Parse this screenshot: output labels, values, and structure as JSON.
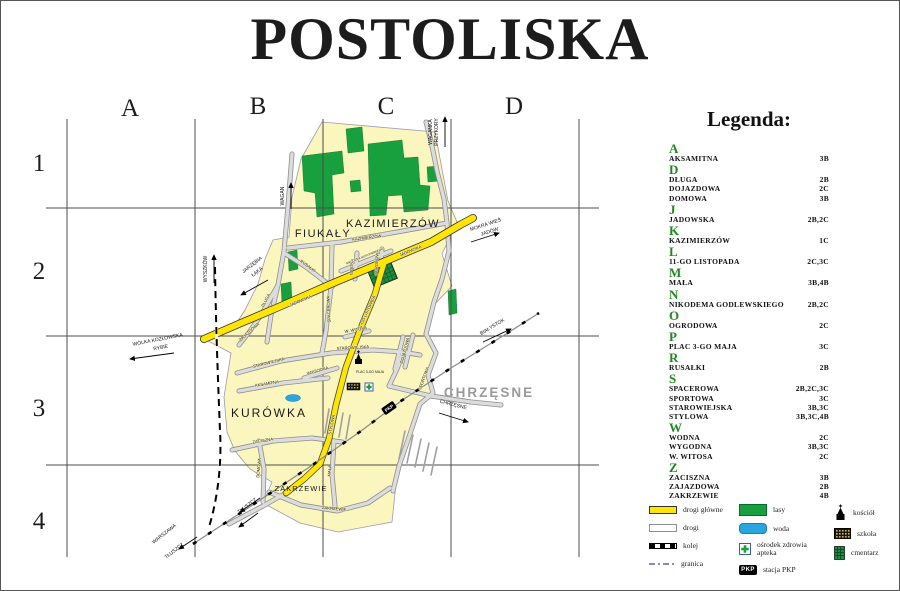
{
  "title": "POSTOLISKA",
  "grid": {
    "columns": [
      "A",
      "B",
      "C",
      "D"
    ],
    "rows": [
      "1",
      "2",
      "3",
      "4"
    ]
  },
  "colors": {
    "village": "#FBF5BE",
    "forest": "#18A03F",
    "main_road": "#FFE500",
    "water": "#2AA5DF",
    "legend_letter_green": "#1E8A1E"
  },
  "map": {
    "areas": {
      "fiukaly": "FIUKAŁY",
      "kazimierzow": "KAZIMIERZÓW",
      "kurowka": "KURÓWKA",
      "zakrzewie": "ZAKRZEWIE",
      "chrzesne": "CHRZĘSNE"
    },
    "street_labels": {
      "jadowska": "JADOWSKA",
      "listopada": "11-GO LISTOPADA",
      "stylowa": "STYLOWA",
      "kazimierzow_st": "KAZIMIERZÓW",
      "spacerowa": "SPACEROWA",
      "starowiejska": "STAROWIEJSKA",
      "wygodna": "WYGODNA",
      "aksamitna": "AKSAMITNA",
      "zaciszna": "ZACISZNA",
      "domowa": "DOMOWA",
      "mala": "MAŁA",
      "zakrzewie_st": "ZAKRZEWIE",
      "rusalki": "RUSAŁKI",
      "dluga": "DŁUGA",
      "zajazdowa": "ZAJAZDOWA",
      "wodna": "WODNA",
      "ogrodowa": "OGRODOWA",
      "sportowa": "SPORTOWA",
      "dojazdowa": "DOJAZDOWA",
      "nikodema": "NIKODEMA GODLEWSKIEGO",
      "witosa": "W. WITOSA",
      "plac": "PLAC 3-GO MAJA"
    },
    "exits": {
      "waganka_1": "WAGANKA",
      "waganka_2": "PRZYKORY",
      "wagan": "WAGAN",
      "wyszkow": "WYSZKÓW",
      "mokra_1": "MOKRA WIEŚ",
      "mokra_2": "JADÓW",
      "jarzebia_1": "JARZĘBIA",
      "jarzebia_2": "ŁĄKA",
      "wolka_1": "WÓLKA KOZŁOWSKA",
      "wolka_2": "RYBIE",
      "bialystok": "BIAŁYSTOK",
      "chrzesne_rd": "CHRZĘSNE",
      "tluszcz": "TŁUSZCZ",
      "warszawa": "WARSZAWA",
      "tluszcz2": "TŁUSZCZ"
    }
  },
  "legend": {
    "title": "Legenda:",
    "groups": [
      {
        "letter": "A",
        "items": [
          {
            "name": "AKSAMITNA",
            "ref": "3B"
          }
        ]
      },
      {
        "letter": "D",
        "items": [
          {
            "name": "DŁUGA",
            "ref": "2B"
          },
          {
            "name": "DOJAZDOWA",
            "ref": "2C"
          },
          {
            "name": "DOMOWA",
            "ref": "3B"
          }
        ]
      },
      {
        "letter": "J",
        "items": [
          {
            "name": "JADOWSKA",
            "ref": "2B,2C"
          }
        ]
      },
      {
        "letter": "K",
        "items": [
          {
            "name": "KAZIMIERZÓW",
            "ref": "1C"
          }
        ]
      },
      {
        "letter": "L",
        "items": [
          {
            "name": "11-GO LISTOPADA",
            "ref": "2C,3C"
          }
        ]
      },
      {
        "letter": "M",
        "items": [
          {
            "name": "MAŁA",
            "ref": "3B,4B"
          }
        ]
      },
      {
        "letter": "N",
        "items": [
          {
            "name": "NIKODEMA GODLEWSKIEGO",
            "ref": "2B,2C"
          }
        ]
      },
      {
        "letter": "O",
        "items": [
          {
            "name": "OGRODOWA",
            "ref": "2C"
          }
        ]
      },
      {
        "letter": "P",
        "items": [
          {
            "name": "PLAC 3-GO MAJA",
            "ref": "3C"
          }
        ]
      },
      {
        "letter": "R",
        "items": [
          {
            "name": "RUSAŁKI",
            "ref": "2B"
          }
        ]
      },
      {
        "letter": "S",
        "items": [
          {
            "name": "SPACEROWA",
            "ref": "2B,2C,3C"
          },
          {
            "name": "SPORTOWA",
            "ref": "3C"
          },
          {
            "name": "STAROWIEJSKA",
            "ref": "3B,3C"
          },
          {
            "name": "STYLOWA",
            "ref": "3B,3C,4B"
          }
        ]
      },
      {
        "letter": "W",
        "items": [
          {
            "name": "WODNA",
            "ref": "2C"
          },
          {
            "name": "WYGODNA",
            "ref": "3B,3C"
          },
          {
            "name": "W. WITOSA",
            "ref": "2C"
          }
        ]
      },
      {
        "letter": "Z",
        "items": [
          {
            "name": "ZACISZNA",
            "ref": "3B"
          },
          {
            "name": "ZAJAZDOWA",
            "ref": "2B"
          },
          {
            "name": "ZAKRZEWIE",
            "ref": "4B"
          }
        ]
      }
    ]
  },
  "symbols": {
    "drogi_glowne": "drogi główne",
    "drogi": "drogi",
    "kolej": "kolej",
    "granica": "granica",
    "lasy": "lasy",
    "woda": "woda",
    "osrodek_1": "ośrodek zdrowia",
    "osrodek_2": "apteka",
    "stacja": "stacja PKP",
    "pkp": "PKP",
    "kosciol": "kościół",
    "szkola": "szkoła",
    "cmentarz": "cmentarz"
  }
}
